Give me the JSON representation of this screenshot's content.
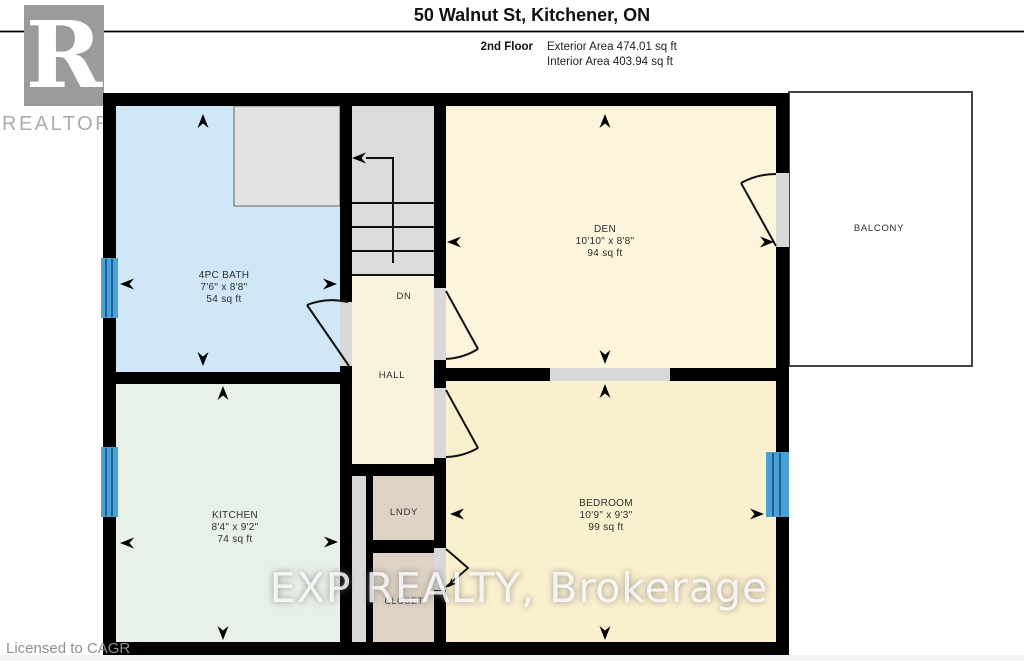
{
  "header": {
    "title": "50 Walnut St, Kitchener, ON",
    "floor_label": "2nd Floor",
    "exterior_area": "Exterior Area 474.01 sq ft",
    "interior_area": "Interior Area 403.94 sq ft"
  },
  "branding": {
    "logo_letter": "R",
    "logo_text": "REALTOR®",
    "license_text": "Licensed to CAGR",
    "watermark": "EXP REALTY, Brokerage"
  },
  "rooms": {
    "bath": {
      "name": "4PC BATH",
      "dims": "7'6\" x 8'8\"",
      "area": "54 sq ft"
    },
    "den": {
      "name": "DEN",
      "dims": "10'10\" x 8'8\"",
      "area": "94 sq ft"
    },
    "kitchen": {
      "name": "KITCHEN",
      "dims": "8'4\" x 9'2\"",
      "area": "74 sq ft"
    },
    "bedroom": {
      "name": "BEDROOM",
      "dims": "10'9\" x 9'3\"",
      "area": "99 sq ft"
    },
    "hall": {
      "name": "HALL"
    },
    "laundry": {
      "name": "LNDY"
    },
    "closet": {
      "name": "CLOSET"
    },
    "balcony": {
      "name": "BALCONY"
    },
    "stairs": {
      "name": "DN"
    }
  },
  "colors": {
    "wall": "#000000",
    "bath": "#cfe7f6",
    "den": "#fcf4db",
    "kitchen": "#e8f1e7",
    "bedroom": "#fbf0cd",
    "hall": "#faf3dc",
    "laundry": "#ded3c4",
    "stairs": "#dcdcdc",
    "inset": "#e3e3e3",
    "threshold": "#d9d9d9",
    "window": "#4ba1d6",
    "window_stripe": "#1c5f93",
    "balcony_border": "#444444",
    "door_line": "#111111",
    "logo_bg": "#9b9b9b"
  }
}
